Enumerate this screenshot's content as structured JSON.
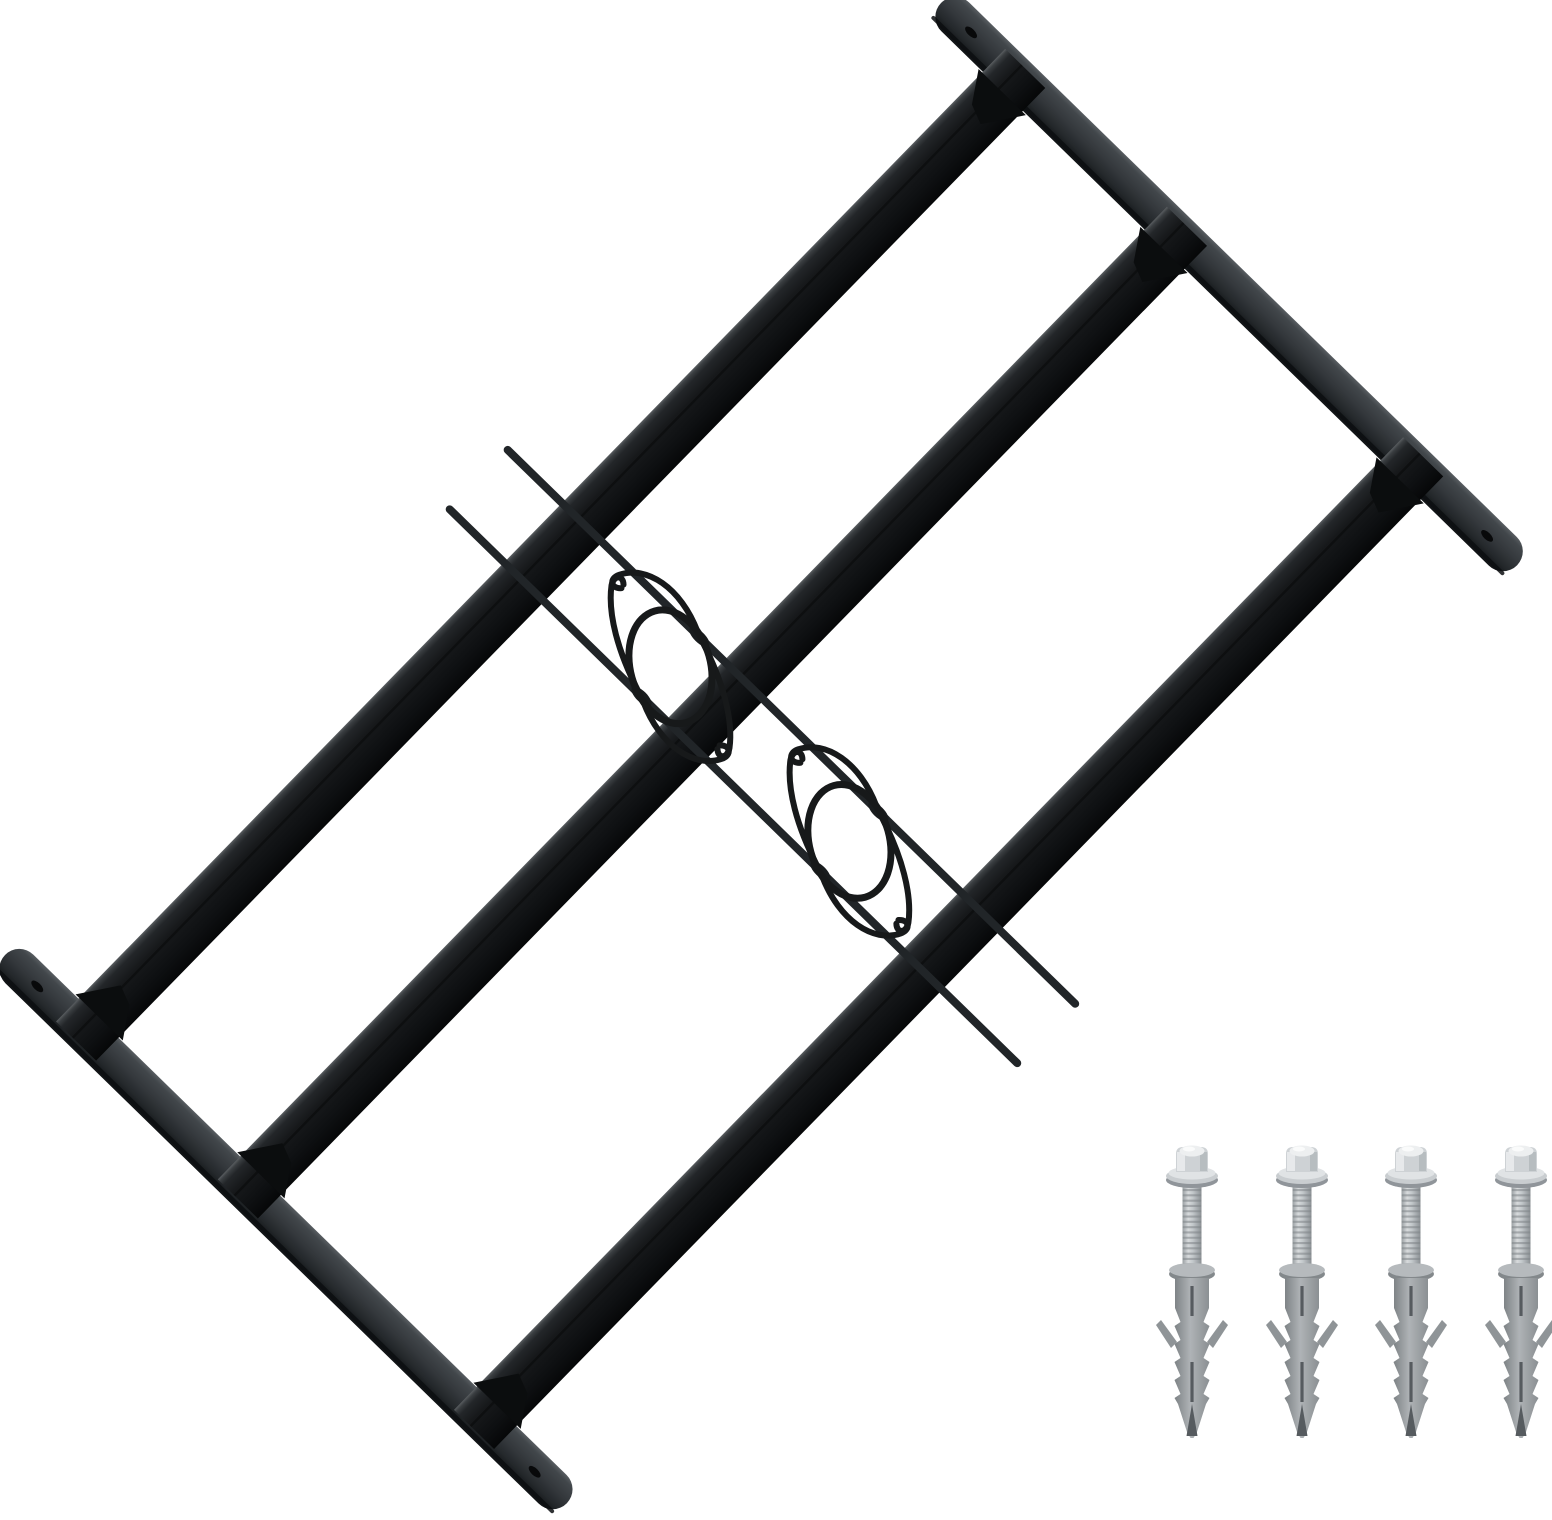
{
  "scene": {
    "background": "#ffffff",
    "width": 1552,
    "height": 1520,
    "product": "adjustable-window-security-grille-with-fixing-kit"
  },
  "grille": {
    "origin": [
      941,
      3
    ],
    "angle_deg": 44.3,
    "rail_thickness": 40,
    "rails": [
      {
        "id": "top",
        "x0": 0,
        "length": 805,
        "y": 0,
        "hole_inset": 42
      },
      {
        "id": "bottom",
        "x0": -5,
        "length": 785,
        "y": 1335,
        "hole_inset": 45
      }
    ],
    "bars": {
      "centers": [
        106,
        332,
        662
      ],
      "width": 56,
      "top": -12,
      "bottom": 1347
    },
    "gusset": {
      "half_base": 33,
      "depth": 39
    },
    "rods": {
      "ys": [
        622.5,
        705.5
      ],
      "x0": -2,
      "x1": 799,
      "thickness": 8
    },
    "ornaments": {
      "xs": [
        270,
        520
      ],
      "cy": 664,
      "rod_half_gap": 41.5,
      "ellipse": {
        "rx": 58,
        "ry": 40,
        "tilt_deg": 30,
        "stroke_w": 7
      },
      "hook_stroke_w": 6
    },
    "colors": {
      "bar_gradient": [
        "#5a5e61",
        "#3a3e41",
        "#232629",
        "#17191b",
        "#0e1012",
        "#060708"
      ],
      "rail_gradient": [
        "#585d61",
        "#42474b",
        "#34383c",
        "#24282b",
        "#0f1214"
      ],
      "rail_edge": "#0c0e10",
      "gusset": "#0b0d0e",
      "rod": "#212528",
      "joint": "#191c1e",
      "ornament": "#17191a",
      "hole": "#08090a",
      "bar_ridge": "#000000"
    }
  },
  "hardware": {
    "screw_count": 4,
    "screw_xs": [
      1192,
      1302,
      1411,
      1521
    ],
    "head_top_y": 1146,
    "plug_tip_y": 1438,
    "colors": {
      "head": "#ced2d5",
      "head_hi": "#edeff0",
      "head_shade": "#aeb3b6",
      "dome_spot": "#fafbfb",
      "flange": "#c9cdd0",
      "flange_hi": "#e0e3e5",
      "flange_shadow": "#90959a",
      "shank_gradient": [
        "#9aa0a3",
        "#d7dadc",
        "#c2c7ca",
        "#8b9094"
      ],
      "thread": "#7e8387",
      "collar": "#b6babd",
      "collar_shadow": "#83888b",
      "plug_gradient": [
        "#7d8285",
        "#afb3b6",
        "#8a8f92"
      ],
      "plug_dark": "#565b5f",
      "wing": "#8f9497"
    }
  }
}
